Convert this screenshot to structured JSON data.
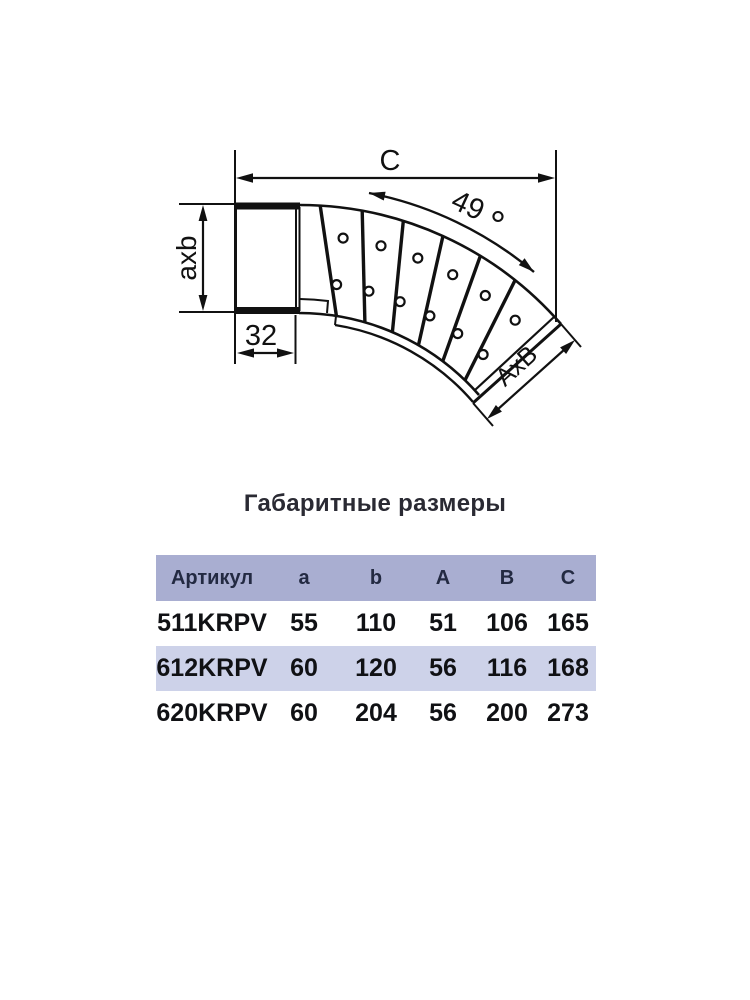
{
  "diagram": {
    "dim_c_label": "C",
    "angle_value": "49",
    "angle_unit": "°",
    "inlet_size_label": "axb",
    "collar_width_label": "32",
    "outlet_size_label": "AxB"
  },
  "table": {
    "title": "Габаритные размеры",
    "columns": [
      "Артикул",
      "a",
      "b",
      "A",
      "B",
      "C"
    ],
    "rows": [
      [
        "511KRPV",
        "55",
        "110",
        "51",
        "106",
        "165"
      ],
      [
        "612KRPV",
        "60",
        "120",
        "56",
        "116",
        "168"
      ],
      [
        "620KRPV",
        "60",
        "204",
        "56",
        "200",
        "273"
      ]
    ]
  },
  "colors": {
    "page_bg": "#ffffff",
    "line_color": "#111111",
    "header_bg": "#a9aed1",
    "header_text": "#232a42",
    "row_alt_bg": "#cdd2e9",
    "data_text": "#101114"
  }
}
